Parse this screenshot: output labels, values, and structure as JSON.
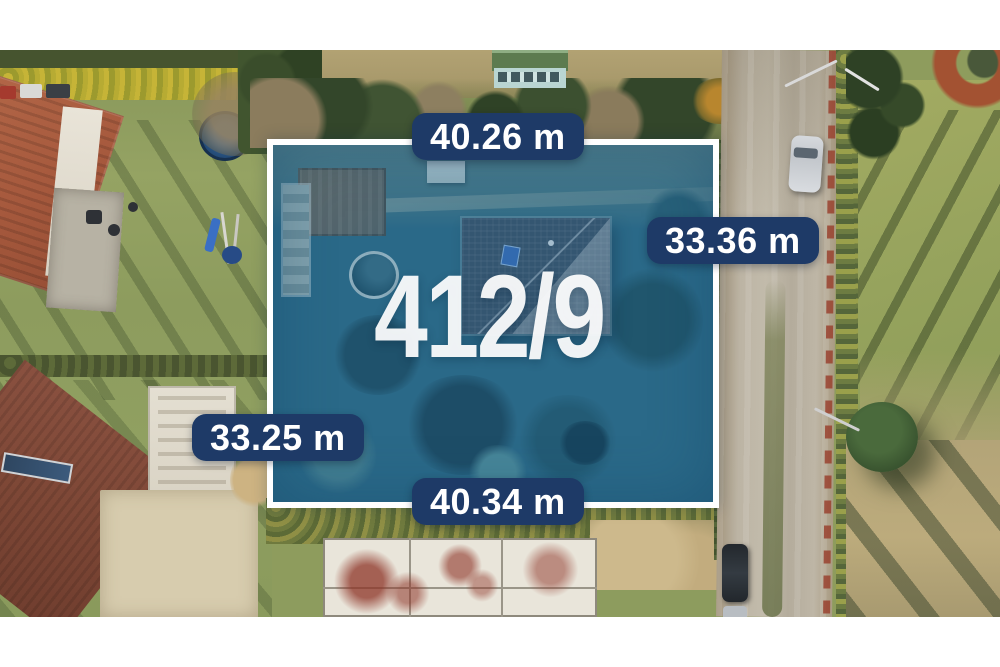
{
  "scene": {
    "type": "aerial-plot-listing-photo"
  },
  "plot": {
    "number": "412/9",
    "dimensions": {
      "top": "40.26 m",
      "right": "33.36 m",
      "left": "33.25 m",
      "bottom": "40.34 m"
    }
  },
  "colors": {
    "label_background": "#1e3a67",
    "label_text": "#ffffff",
    "plot_border": "#ffffff",
    "plot_overlay_tint": "#206088",
    "photo_margin": "#ffffff"
  }
}
